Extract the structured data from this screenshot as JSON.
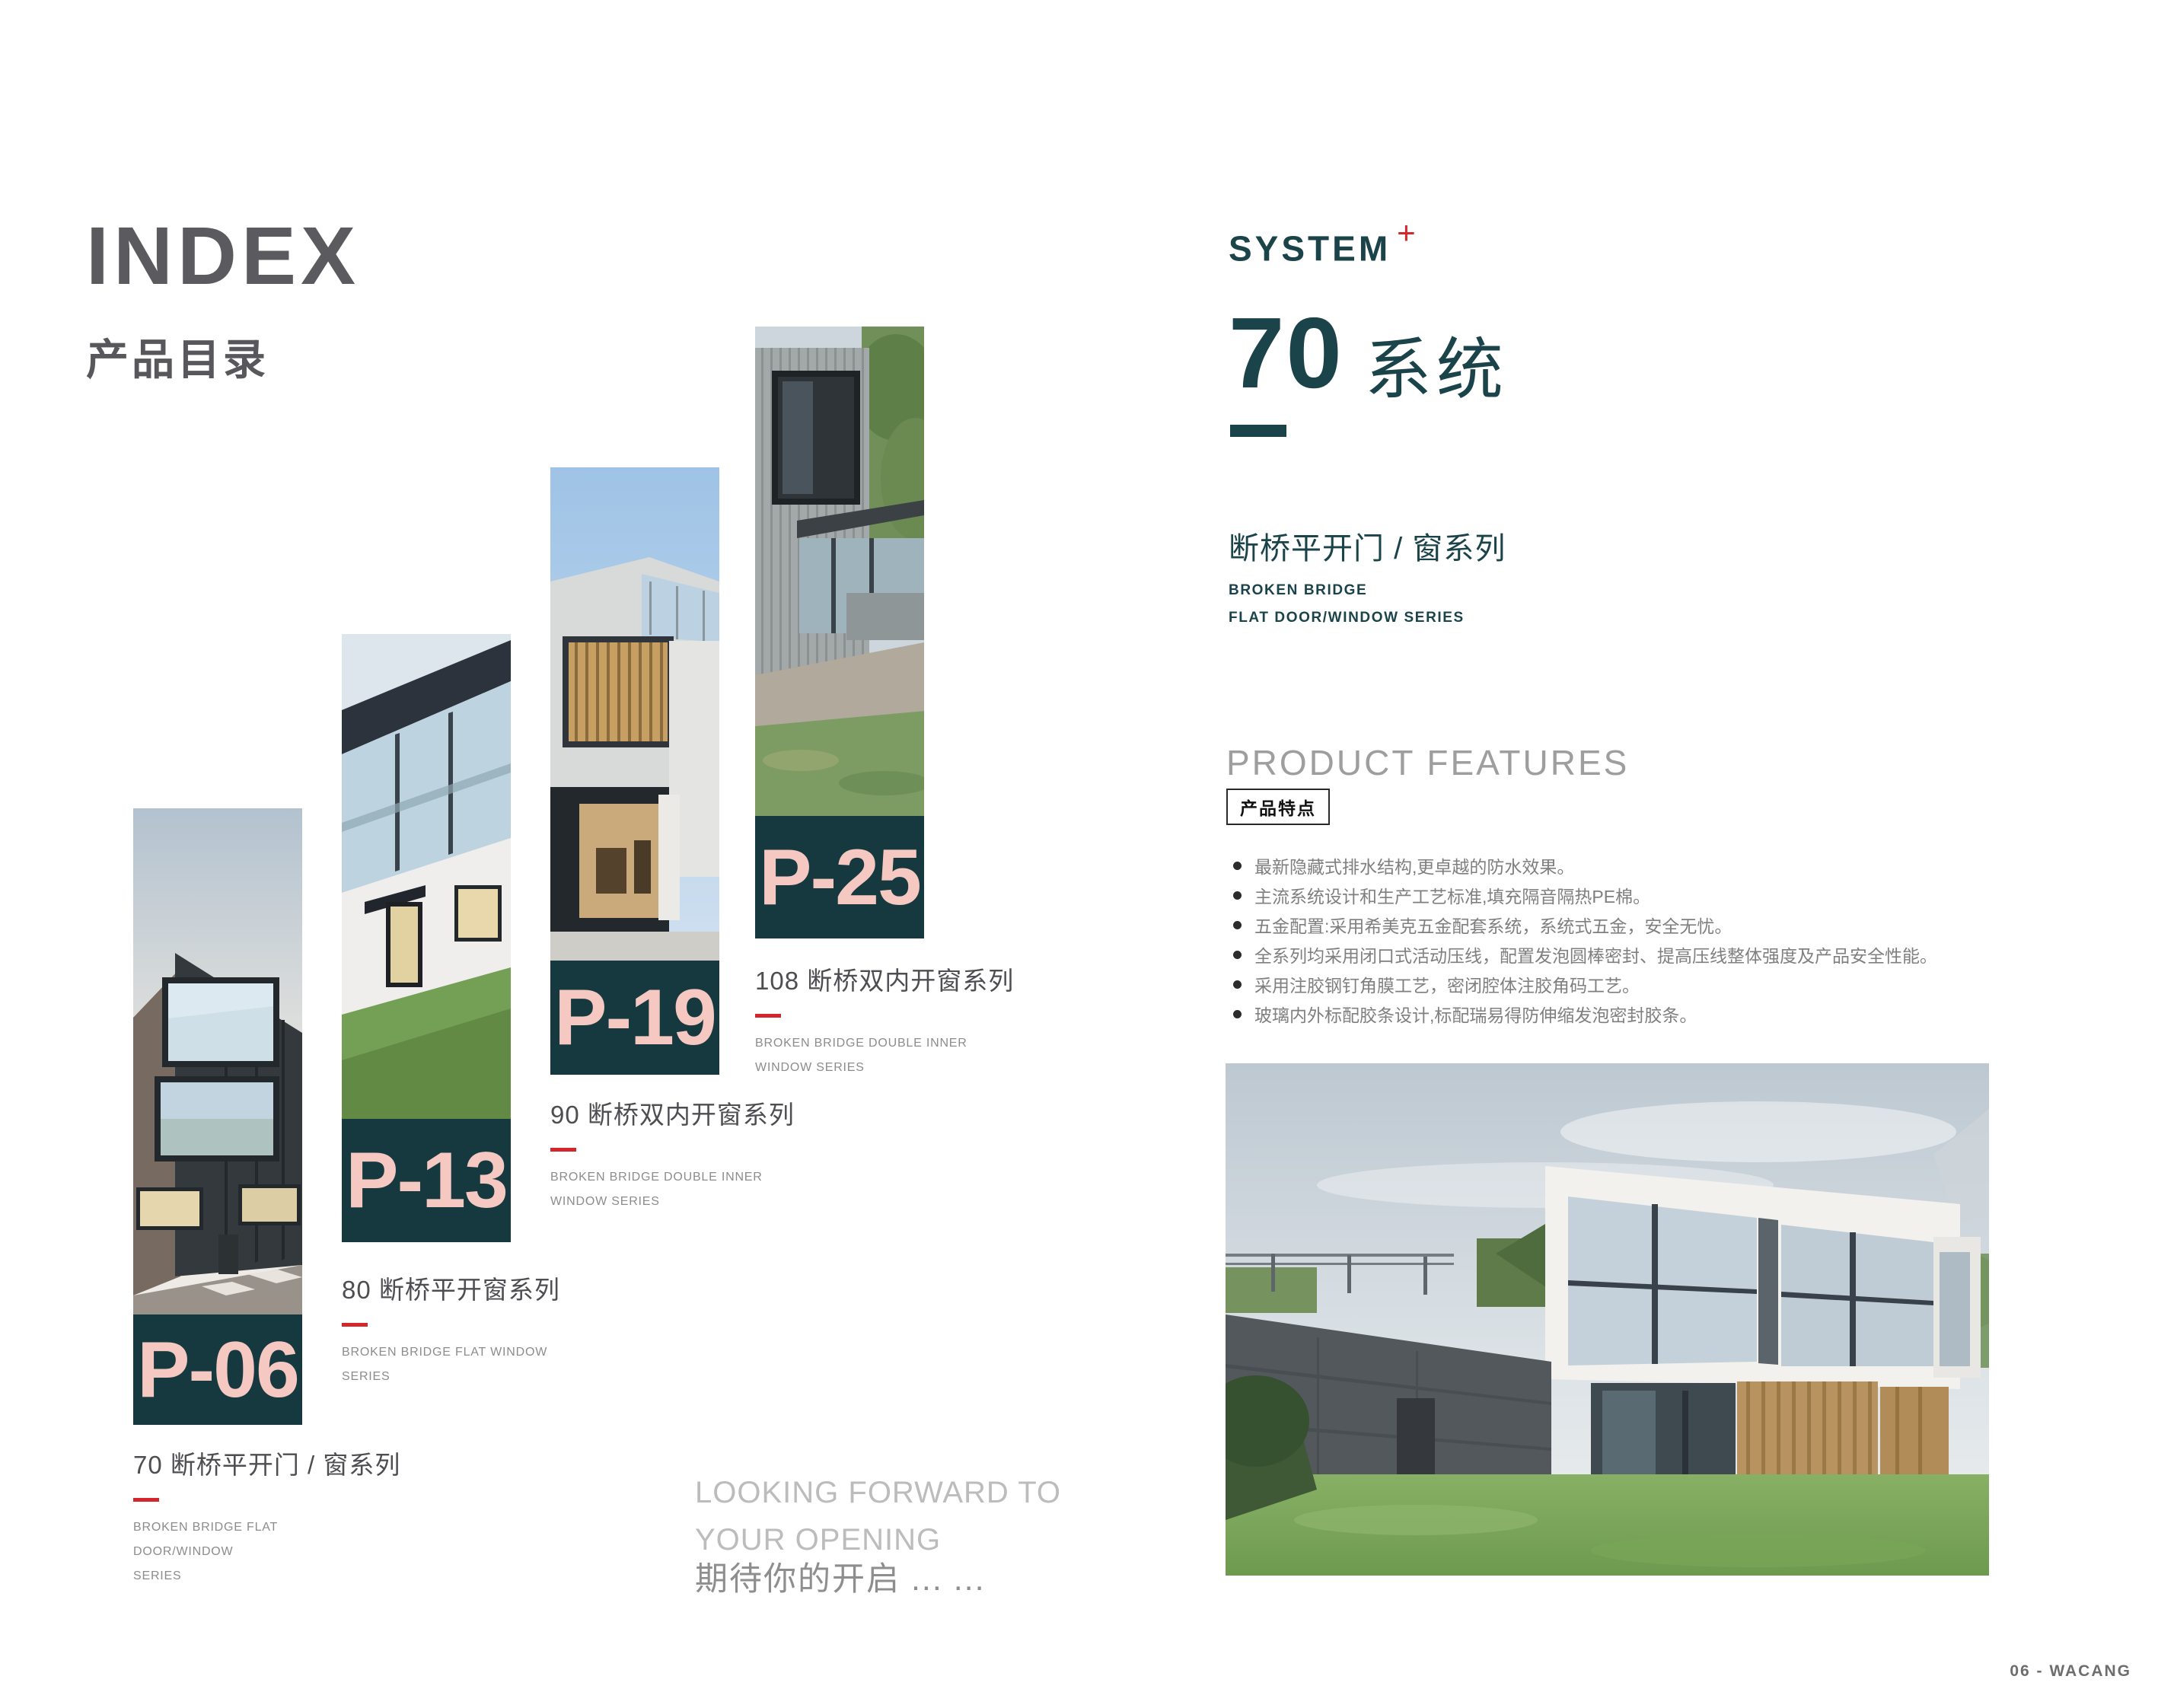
{
  "left": {
    "title": "INDEX",
    "subtitle": "产品目录",
    "items": [
      {
        "code": "P-06",
        "title": "70 断桥平开门 / 窗系列",
        "subtitle_line1": "BROKEN BRIDGE FLAT DOOR/WINDOW",
        "subtitle_line2": "SERIES"
      },
      {
        "code": "P-13",
        "title": "80 断桥平开窗系列",
        "subtitle_line1": "BROKEN BRIDGE FLAT WINDOW",
        "subtitle_line2": "SERIES"
      },
      {
        "code": "P-19",
        "title": "90 断桥双内开窗系列",
        "subtitle_line1": "BROKEN BRIDGE DOUBLE INNER",
        "subtitle_line2": "WINDOW SERIES"
      },
      {
        "code": "P-25",
        "title": "108 断桥双内开窗系列",
        "subtitle_line1": "BROKEN BRIDGE DOUBLE INNER",
        "subtitle_line2": "WINDOW SERIES"
      }
    ],
    "outro_en_line1": "LOOKING FORWARD TO",
    "outro_en_line2": "YOUR OPENING",
    "outro_zh": "期待你的开启 ... ..."
  },
  "right": {
    "brand": "SYSTEM",
    "brand_plus": "+",
    "system_number": "70",
    "system_word": "系统",
    "series_zh": "断桥平开门 / 窗系列",
    "series_en_line1": "BROKEN BRIDGE",
    "series_en_line2": "FLAT DOOR/WINDOW SERIES",
    "features_heading": "PRODUCT FEATURES",
    "features_badge": "产品特点",
    "features": [
      "最新隐藏式排水结构,更卓越的防水效果。",
      "主流系统设计和生产工艺标准,填充隔音隔热PE棉。",
      "五金配置:采用希美克五金配套系统，系统式五金，安全无忧。",
      "全系列均采用闭口式活动压线，配置发泡圆棒密封、提高压线整体强度及产品安全性能。",
      "采用注胶钢钉角膜工艺，密闭腔体注胶角码工艺。",
      "玻璃内外标配胶条设计,标配瑞易得防伸缩发泡密封胶条。"
    ],
    "footer": "06 - WACANG"
  },
  "colors": {
    "accent_red": "#D5262B",
    "block_teal": "#16393F",
    "brand_teal": "#1B434A",
    "code_pink": "#F5C8C2",
    "heading_gray": "#5B5B5F"
  }
}
